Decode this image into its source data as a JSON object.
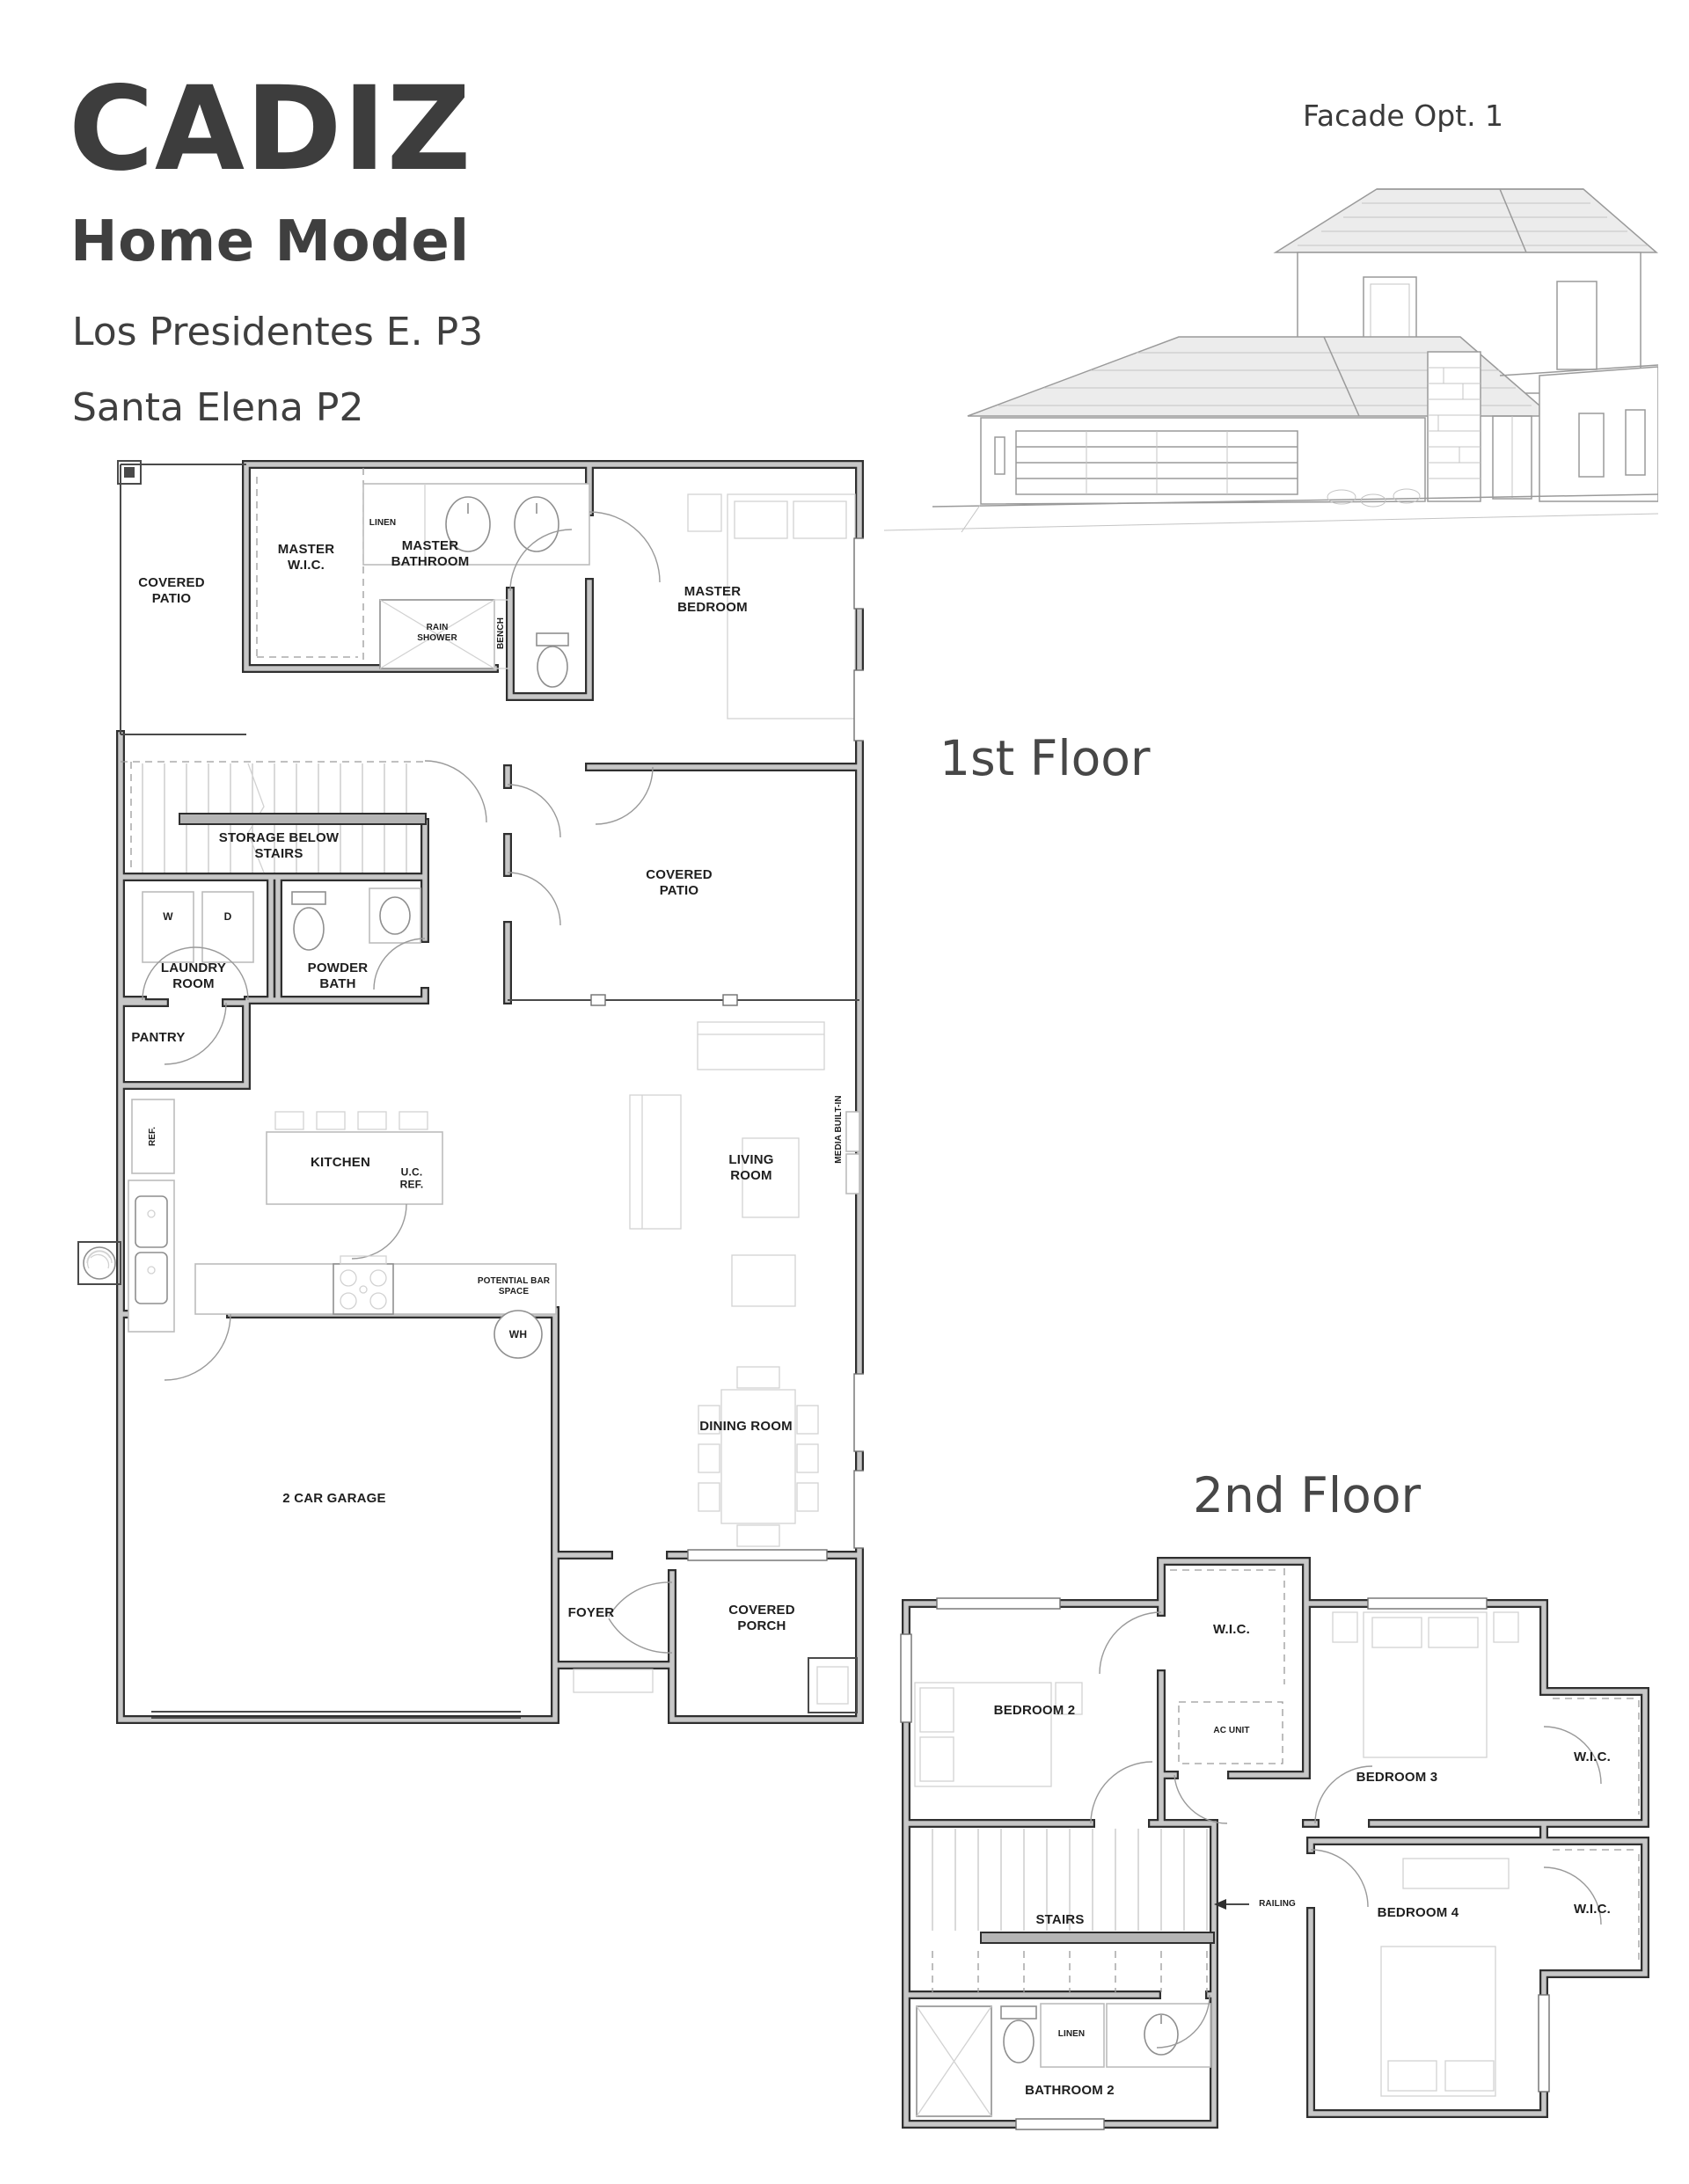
{
  "header": {
    "title": "CADIZ",
    "subtitle": "Home Model",
    "plan_line_1": "Los Presidentes E. P3",
    "plan_line_2": "Santa Elena P2",
    "facade_label": "Facade Opt. 1"
  },
  "floor1": {
    "heading": "1st Floor",
    "rooms": {
      "covered_patio_left": "COVERED PATIO",
      "master_wic": "MASTER W.I.C.",
      "master_bathroom": "MASTER BATHROOM",
      "linen": "LINEN",
      "rain_shower": "RAIN SHOWER",
      "bench": "BENCH",
      "master_bedroom": "MASTER BEDROOM",
      "storage_below_stairs": "STORAGE BELOW STAIRS",
      "washer": "W",
      "dryer": "D",
      "laundry_room": "LAUNDRY ROOM",
      "powder_bath": "POWDER BATH",
      "covered_patio_right": "COVERED PATIO",
      "pantry": "PANTRY",
      "ref": "REF.",
      "kitchen": "KITCHEN",
      "uc_ref": "U.C. REF.",
      "living_room": "LIVING ROOM",
      "media_built_in": "MEDIA BUILT-IN",
      "potential_bar_space": "POTENTIAL BAR SPACE",
      "water_heater": "WH",
      "garage": "2 CAR GARAGE",
      "dining_room": "DINING ROOM",
      "foyer": "FOYER",
      "covered_porch": "COVERED PORCH"
    }
  },
  "floor2": {
    "heading": "2nd Floor",
    "rooms": {
      "wic_top": "W.I.C.",
      "bedroom_2": "BEDROOM 2",
      "ac_unit": "AC UNIT",
      "bedroom_3": "BEDROOM 3",
      "wic_right": "W.I.C.",
      "stairs": "STAIRS",
      "railing": "RAILING",
      "bedroom_4": "BEDROOM 4",
      "wic_bottom": "W.I.C.",
      "linen": "LINEN",
      "bathroom_2": "BATHROOM 2"
    }
  },
  "colors": {
    "heading_text": "#3d3d3d",
    "plan_text": "#1e1e1e",
    "wall_edge": "#2f2f2f",
    "wall_fill": "#c7c7c7",
    "light_line": "#bcbcbc"
  }
}
